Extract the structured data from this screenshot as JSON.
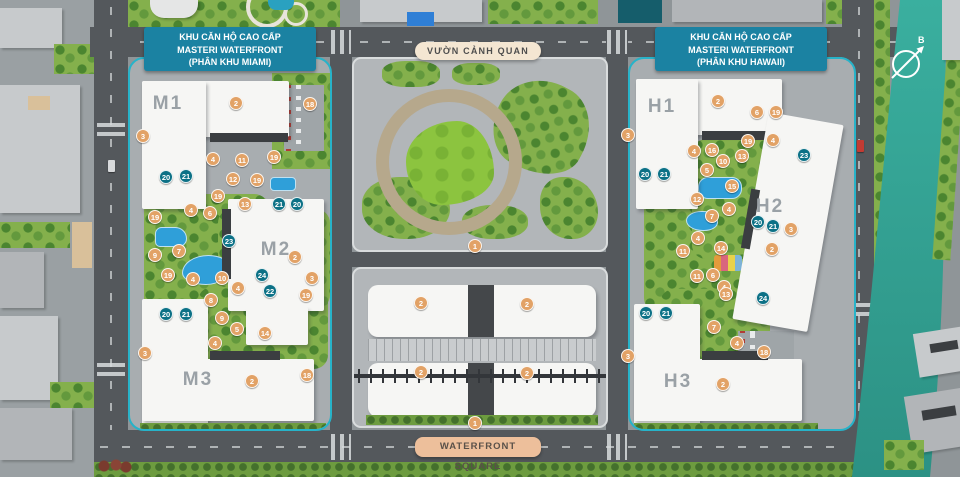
{
  "map": {
    "banners": {
      "miami": {
        "line1": "KHU CĂN HỘ CAO CẤP",
        "line2": "MASTERI WATERFRONT",
        "line3": "(PHÂN KHU MIAMI)"
      },
      "hawaii": {
        "line1": "KHU CĂN HỘ CAO CẤP",
        "line2": "MASTERI WATERFRONT",
        "line3": "(PHÂN KHU HAWAII)"
      },
      "garden": "VƯỜN CẢNH QUAN",
      "square": "WATERFRONT SQUARE"
    },
    "compass": {
      "label": "B"
    },
    "buildings": [
      {
        "label": "M1",
        "x": 168,
        "y": 104
      },
      {
        "label": "M2",
        "x": 276,
        "y": 250
      },
      {
        "label": "M3",
        "x": 198,
        "y": 380
      },
      {
        "label": "H1",
        "x": 662,
        "y": 107
      },
      {
        "label": "H2",
        "x": 770,
        "y": 207
      },
      {
        "label": "H3",
        "x": 678,
        "y": 382
      }
    ],
    "markers": [
      [
        2,
        236,
        103
      ],
      [
        18,
        310,
        104
      ],
      [
        3,
        143,
        136
      ],
      [
        4,
        213,
        159
      ],
      [
        11,
        242,
        160
      ],
      [
        19,
        274,
        157
      ],
      [
        20,
        166,
        177
      ],
      [
        21,
        186,
        176
      ],
      [
        12,
        233,
        179
      ],
      [
        19,
        257,
        180
      ],
      [
        19,
        218,
        196
      ],
      [
        13,
        245,
        204
      ],
      [
        21,
        279,
        204
      ],
      [
        20,
        297,
        204
      ],
      [
        4,
        191,
        210
      ],
      [
        6,
        210,
        213
      ],
      [
        19,
        155,
        217
      ],
      [
        23,
        229,
        241
      ],
      [
        7,
        179,
        251
      ],
      [
        9,
        155,
        255
      ],
      [
        2,
        295,
        257
      ],
      [
        19,
        168,
        275
      ],
      [
        10,
        222,
        278
      ],
      [
        24,
        262,
        275
      ],
      [
        3,
        312,
        278
      ],
      [
        4,
        193,
        279
      ],
      [
        4,
        238,
        288
      ],
      [
        22,
        270,
        291
      ],
      [
        8,
        211,
        300
      ],
      [
        19,
        306,
        295
      ],
      [
        9,
        222,
        318
      ],
      [
        5,
        237,
        329
      ],
      [
        14,
        265,
        333
      ],
      [
        4,
        215,
        343
      ],
      [
        20,
        166,
        314
      ],
      [
        21,
        186,
        314
      ],
      [
        3,
        145,
        353
      ],
      [
        2,
        252,
        381
      ],
      [
        18,
        307,
        375
      ],
      [
        2,
        718,
        101
      ],
      [
        6,
        757,
        112
      ],
      [
        19,
        776,
        112
      ],
      [
        3,
        628,
        135
      ],
      [
        19,
        748,
        141
      ],
      [
        4,
        773,
        140
      ],
      [
        4,
        694,
        151
      ],
      [
        16,
        712,
        150
      ],
      [
        13,
        742,
        156
      ],
      [
        10,
        723,
        161
      ],
      [
        5,
        707,
        170
      ],
      [
        20,
        645,
        174
      ],
      [
        21,
        664,
        174
      ],
      [
        15,
        732,
        186
      ],
      [
        23,
        804,
        155
      ],
      [
        12,
        697,
        199
      ],
      [
        4,
        729,
        209
      ],
      [
        7,
        712,
        216
      ],
      [
        20,
        758,
        222
      ],
      [
        21,
        773,
        226
      ],
      [
        3,
        791,
        229
      ],
      [
        2,
        772,
        249
      ],
      [
        4,
        698,
        238
      ],
      [
        14,
        721,
        248
      ],
      [
        11,
        683,
        251
      ],
      [
        11,
        697,
        276
      ],
      [
        6,
        713,
        275
      ],
      [
        4,
        724,
        287
      ],
      [
        24,
        763,
        298
      ],
      [
        13,
        726,
        294
      ],
      [
        20,
        646,
        313
      ],
      [
        21,
        666,
        313
      ],
      [
        7,
        714,
        327
      ],
      [
        4,
        737,
        343
      ],
      [
        18,
        764,
        352
      ],
      [
        3,
        628,
        356
      ],
      [
        2,
        723,
        384
      ],
      [
        1,
        475,
        246
      ],
      [
        2,
        421,
        303
      ],
      [
        2,
        527,
        304
      ],
      [
        2,
        421,
        372
      ],
      [
        2,
        527,
        373
      ],
      [
        1,
        475,
        423
      ]
    ],
    "colors": {
      "marker_orange": "#e2a266",
      "marker_teal": "#0c7186",
      "banner_teal": "#1b82a2",
      "banner_cream": "#f4e6d2",
      "banner_tan": "#edbf9b",
      "site_boundary": "#27b3c9",
      "river": "#35a597",
      "pool": "#2f9fd9"
    }
  }
}
